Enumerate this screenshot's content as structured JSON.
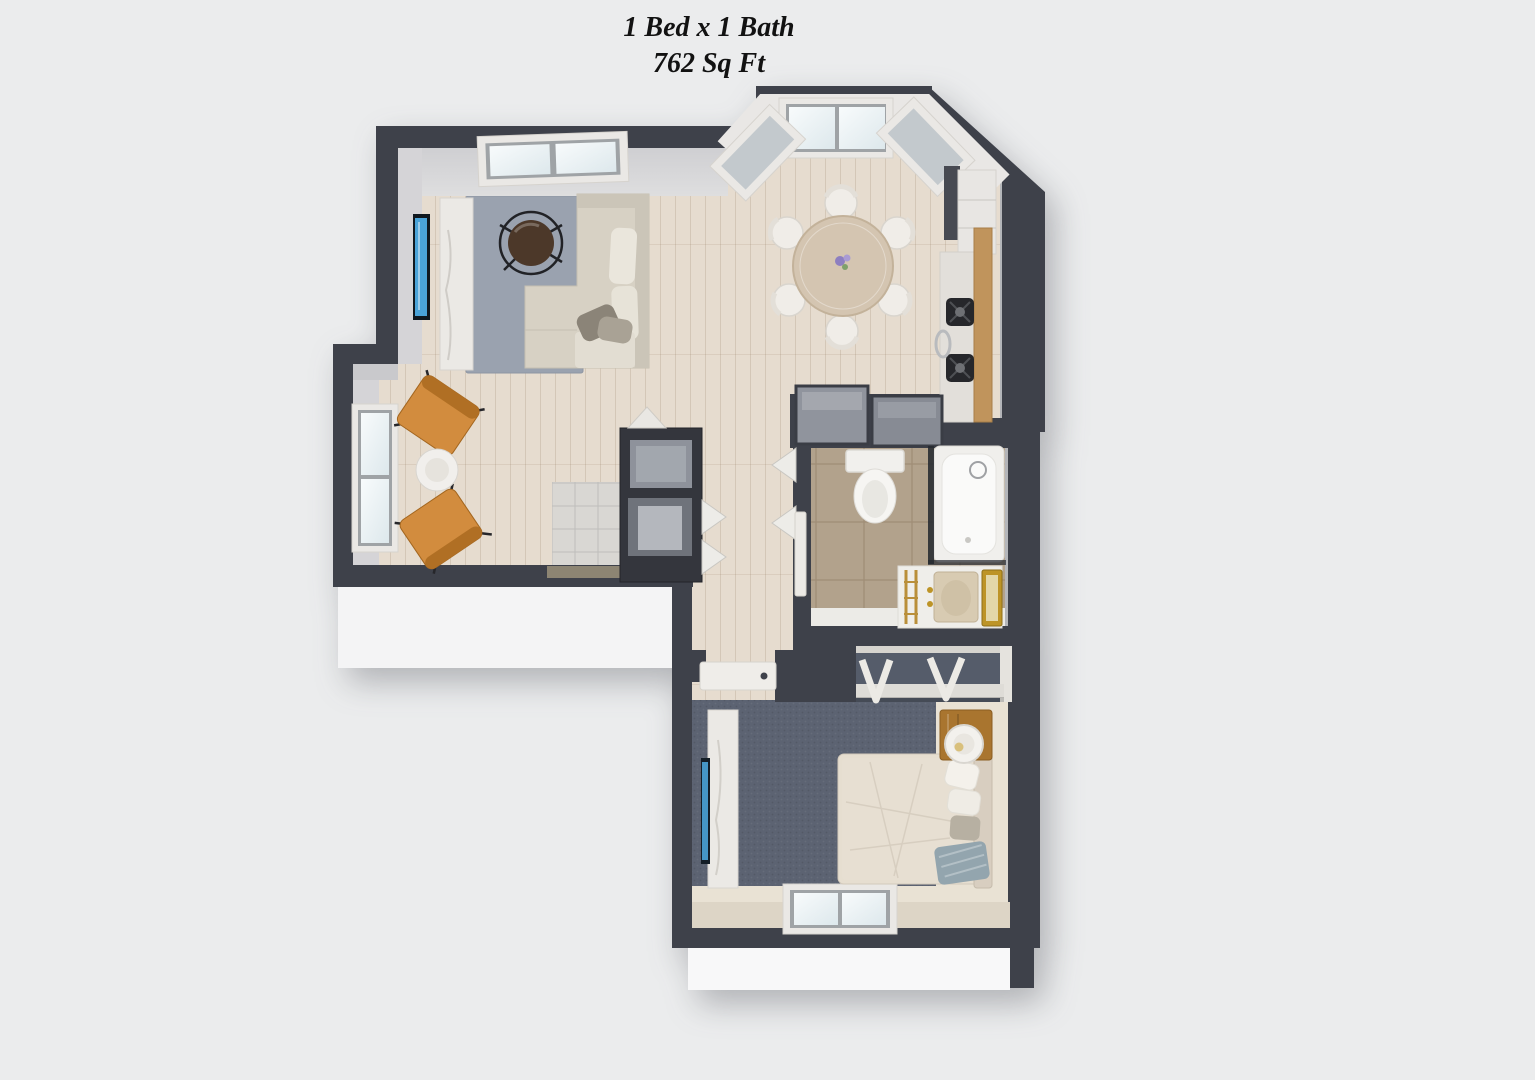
{
  "title": {
    "line1": "1 Bed x 1 Bath",
    "line2": "762 Sq Ft"
  },
  "palette": {
    "background": "#ebeced",
    "wall": "#3e414a",
    "wood_floor": "#e6dccf",
    "bedroom_floor": "#e9e2d4",
    "carpet": "#5c6372",
    "closet_carpet": "#555c6a",
    "rug": "#9aa2af",
    "tile_bath": "#b2a28c",
    "entry_tile": "#d9d7d3",
    "sofa": "#d7d1c4",
    "accent_chair": "#d28c3e",
    "tv_screen": "#4aa3d8",
    "dining_table": "#d4c5b1",
    "counter_wood": "#c0945c",
    "nightstand_wood": "#a9752f",
    "brass": "#bd9427",
    "bed_linen": "#e7dfd2",
    "window_glass": "#f3f7f8"
  }
}
